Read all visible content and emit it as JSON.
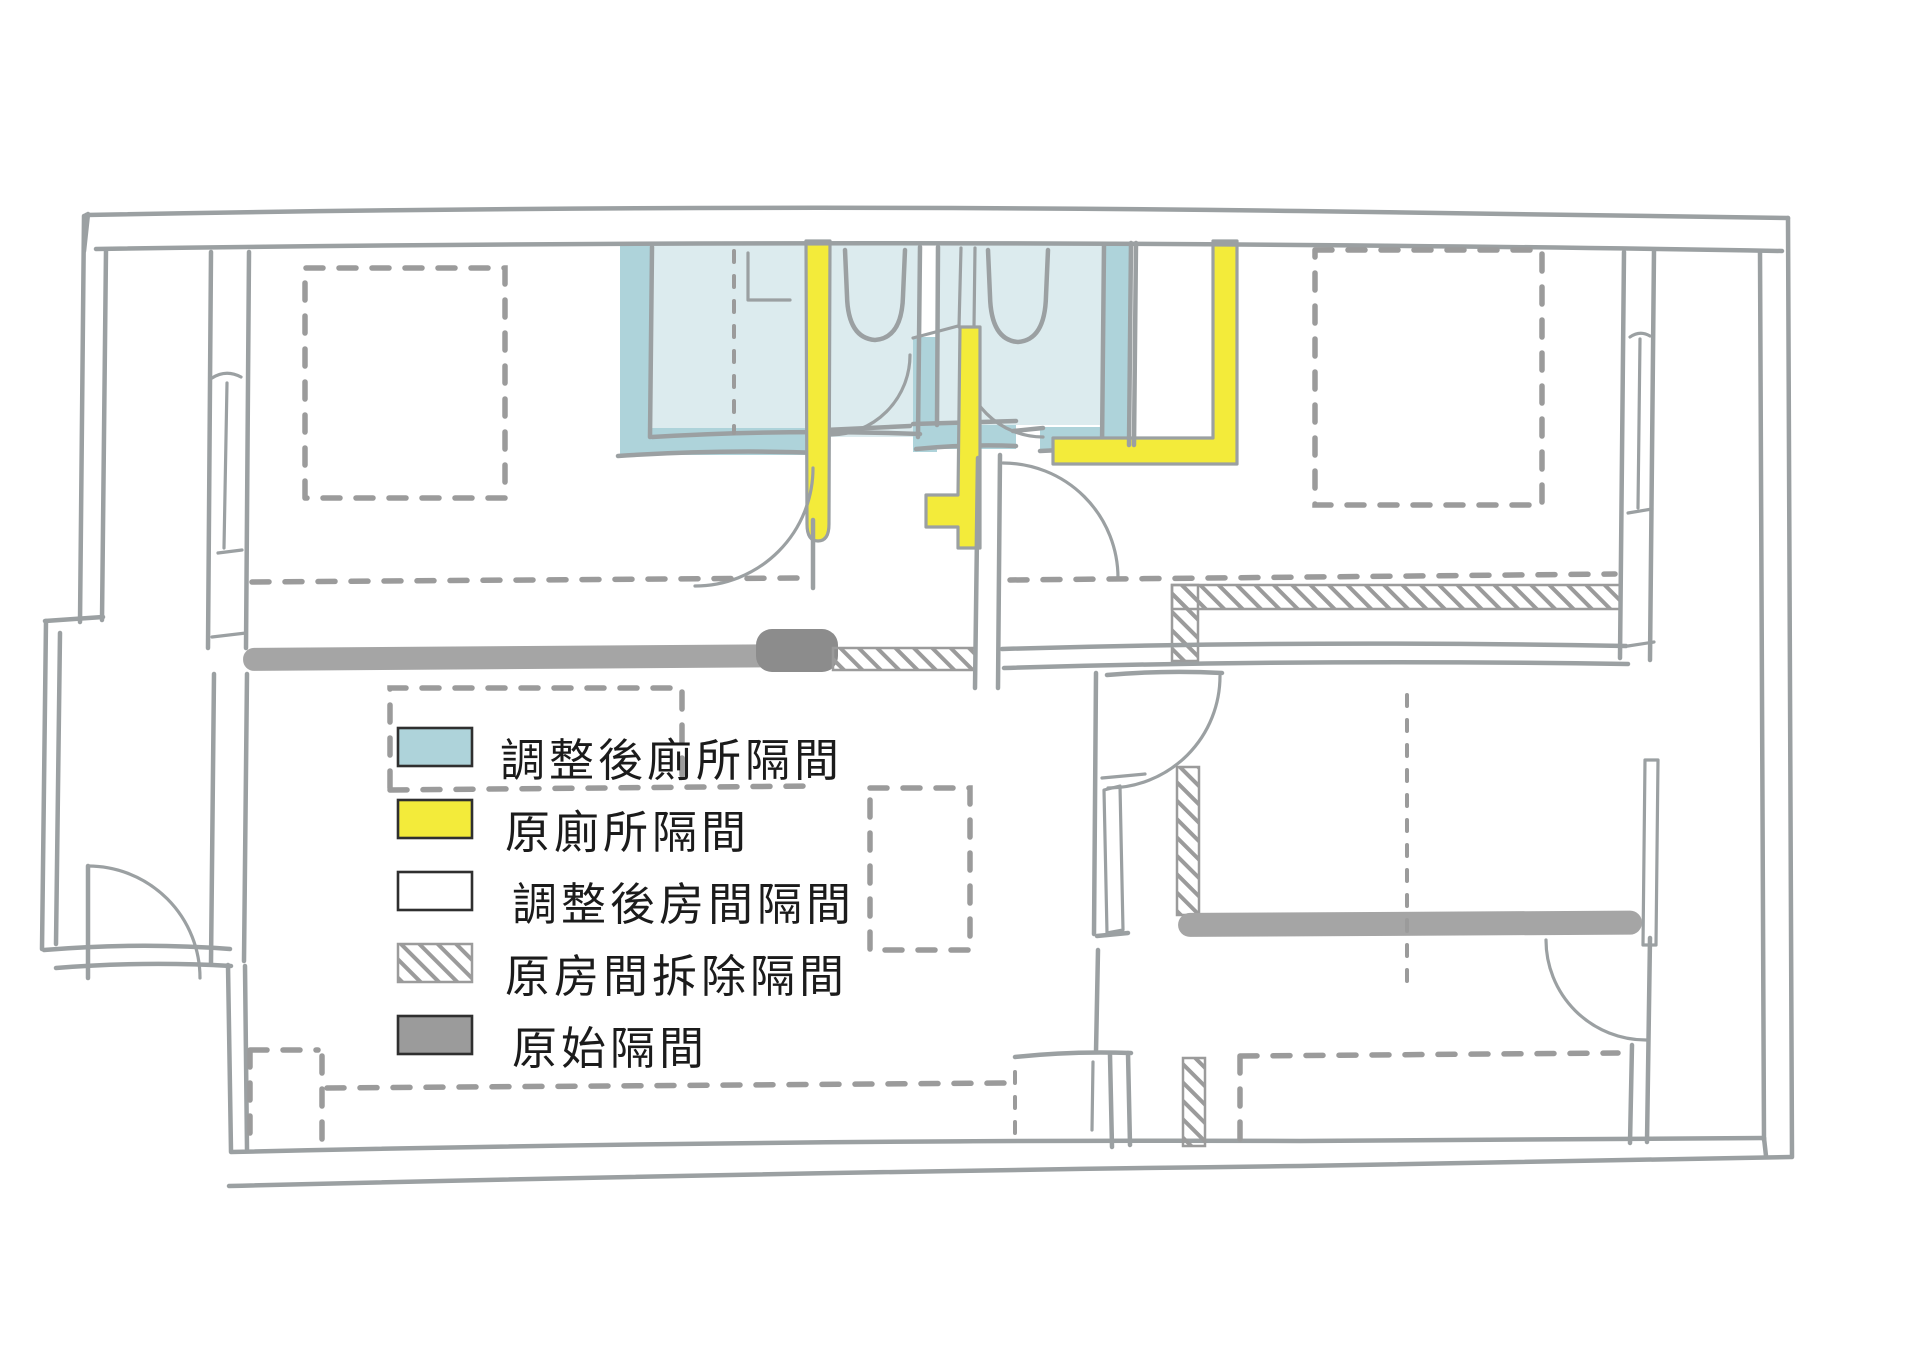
{
  "title": "hand-drawn floor plan partition diagram",
  "legend": {
    "items": [
      {
        "id": "toilet-partition-adjusted",
        "label": "調整後廁所隔間",
        "swatch_color": "#aed3da",
        "swatch_style": "solid"
      },
      {
        "id": "toilet-partition-original",
        "label": "原廁所隔間",
        "swatch_color": "#f3eb3a",
        "swatch_style": "solid"
      },
      {
        "id": "room-partition-adjusted",
        "label": "調整後房間隔間",
        "swatch_color": "#ffffff",
        "swatch_style": "solid"
      },
      {
        "id": "room-partition-demolished",
        "label": "原房間拆除隔間",
        "swatch_color": "#ffffff",
        "swatch_style": "hatched"
      },
      {
        "id": "partition-original",
        "label": "原始隔間",
        "swatch_color": "#9b9b9b",
        "swatch_style": "solid"
      }
    ]
  },
  "palette": {
    "background": "#ffffff",
    "wall_line": "#9ba0a2",
    "blue_fill": "#dcebee",
    "blue_border": "#aed3da",
    "yellow": "#f3eb3a",
    "gray_band": "#a5a5a5",
    "gray_band_dark": "#8c8c8c",
    "hatch_stroke": "#9b9b9b",
    "text": "#1b1b1b"
  }
}
